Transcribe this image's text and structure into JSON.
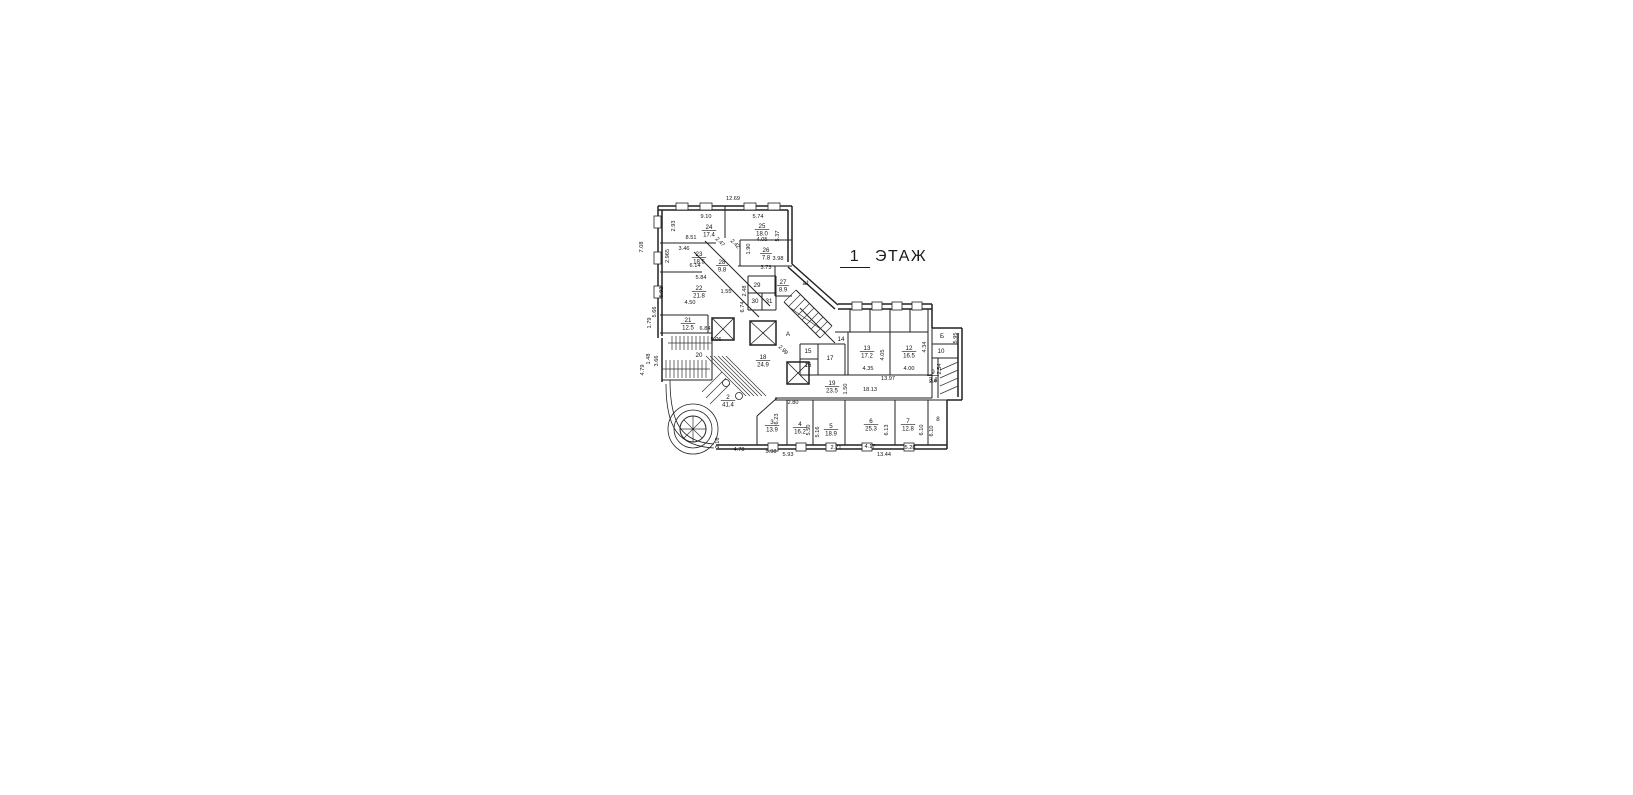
{
  "title": {
    "number": "1",
    "word": "ЭТАЖ"
  },
  "colors": {
    "ink": "#222222",
    "background": "#ffffff"
  },
  "plan": {
    "rooms": [
      {
        "num": "24",
        "area": "17.4",
        "x": 709,
        "y": 229
      },
      {
        "num": "25",
        "area": "18.0",
        "x": 762,
        "y": 228
      },
      {
        "num": "23",
        "area": "18.5",
        "x": 699,
        "y": 256
      },
      {
        "num": "26",
        "area": "7.8",
        "x": 766,
        "y": 252
      },
      {
        "num": "28",
        "area": "9.8",
        "x": 722,
        "y": 264
      },
      {
        "num": "27",
        "area": "8.9",
        "x": 783,
        "y": 284
      },
      {
        "num": "22",
        "area": "21.8",
        "x": 699,
        "y": 290
      },
      {
        "num": "21",
        "area": "12.5",
        "x": 688,
        "y": 322
      },
      {
        "num": "18",
        "area": "24.9",
        "x": 763,
        "y": 359
      },
      {
        "num": "2",
        "area": "41.4",
        "x": 728,
        "y": 399
      },
      {
        "num": "3",
        "area": "13.9",
        "x": 772,
        "y": 424
      },
      {
        "num": "4",
        "area": "16.2",
        "x": 800,
        "y": 426
      },
      {
        "num": "5",
        "area": "18.9",
        "x": 831,
        "y": 428
      },
      {
        "num": "6",
        "area": "25.3",
        "x": 871,
        "y": 423
      },
      {
        "num": "7",
        "area": "12.8",
        "x": 908,
        "y": 423
      },
      {
        "num": "13",
        "area": "17.2",
        "x": 867,
        "y": 350
      },
      {
        "num": "12",
        "area": "16.5",
        "x": 909,
        "y": 350
      },
      {
        "num": "19",
        "area": "23.5",
        "x": 832,
        "y": 385
      },
      {
        "num": "9",
        "area": "3.4",
        "x": 933,
        "y": 374
      }
    ],
    "marks": [
      {
        "t": "20",
        "x": 699,
        "y": 357
      },
      {
        "t": "29",
        "x": 757,
        "y": 287
      },
      {
        "t": "30",
        "x": 755,
        "y": 303
      },
      {
        "t": "31",
        "x": 769,
        "y": 303
      },
      {
        "t": "14",
        "x": 841,
        "y": 341
      },
      {
        "t": "17",
        "x": 830,
        "y": 360
      },
      {
        "t": "15",
        "x": 808,
        "y": 353
      },
      {
        "t": "16",
        "x": 808,
        "y": 367
      },
      {
        "t": "10",
        "x": 941,
        "y": 353
      },
      {
        "t": "8",
        "x": 938,
        "y": 421
      },
      {
        "t": "А",
        "x": 788,
        "y": 336
      },
      {
        "t": "Б",
        "x": 942,
        "y": 338
      },
      {
        "t": "а1",
        "x": 806,
        "y": 285
      }
    ],
    "dims": [
      {
        "v": "12.69",
        "x": 733,
        "y": 200,
        "rot": 0
      },
      {
        "v": "9.10",
        "x": 706,
        "y": 218,
        "rot": 0
      },
      {
        "v": "2.93",
        "x": 675,
        "y": 226,
        "rot": 90
      },
      {
        "v": "8.51",
        "x": 691,
        "y": 239,
        "rot": 0
      },
      {
        "v": "5.74",
        "x": 758,
        "y": 218,
        "rot": 0
      },
      {
        "v": "5.37",
        "x": 779,
        "y": 236,
        "rot": 90
      },
      {
        "v": "4.05",
        "x": 762,
        "y": 241,
        "rot": 0
      },
      {
        "v": "3.46",
        "x": 684,
        "y": 250,
        "rot": 0
      },
      {
        "v": "2.965",
        "x": 669,
        "y": 256,
        "rot": 90
      },
      {
        "v": "2.47",
        "x": 719,
        "y": 243,
        "rot": 45
      },
      {
        "v": "2.42",
        "x": 734,
        "y": 245,
        "rot": 45
      },
      {
        "v": "1.90",
        "x": 750,
        "y": 249,
        "rot": 90
      },
      {
        "v": "3.98",
        "x": 778,
        "y": 260,
        "rot": 0
      },
      {
        "v": "3.73",
        "x": 766,
        "y": 269,
        "rot": 0
      },
      {
        "v": "6.14",
        "x": 695,
        "y": 267,
        "rot": 0
      },
      {
        "v": "5.84",
        "x": 701,
        "y": 279,
        "rot": 0
      },
      {
        "v": "5.92",
        "x": 663,
        "y": 292,
        "rot": 90
      },
      {
        "v": "2.48",
        "x": 746,
        "y": 291,
        "rot": 90
      },
      {
        "v": "1.55",
        "x": 726,
        "y": 293,
        "rot": 0
      },
      {
        "v": "6.74",
        "x": 744,
        "y": 307,
        "rot": 90
      },
      {
        "v": "4.50",
        "x": 690,
        "y": 304,
        "rot": 0
      },
      {
        "v": "7.08",
        "x": 643,
        "y": 247,
        "rot": 90
      },
      {
        "v": "5.66",
        "x": 656,
        "y": 312,
        "rot": 90
      },
      {
        "v": "1.79",
        "x": 651,
        "y": 323,
        "rot": 90
      },
      {
        "v": "6.84",
        "x": 705,
        "y": 330,
        "rot": 0
      },
      {
        "v": "5.06",
        "x": 716,
        "y": 341,
        "rot": 0
      },
      {
        "v": "1.48",
        "x": 650,
        "y": 359,
        "rot": 90
      },
      {
        "v": "3.66",
        "x": 658,
        "y": 361,
        "rot": 90
      },
      {
        "v": "4.79",
        "x": 644,
        "y": 370,
        "rot": 90
      },
      {
        "v": "2.99",
        "x": 782,
        "y": 351,
        "rot": 45
      },
      {
        "v": "4.35",
        "x": 868,
        "y": 370,
        "rot": 0
      },
      {
        "v": "4.05",
        "x": 884,
        "y": 355,
        "rot": 90
      },
      {
        "v": "4.00",
        "x": 909,
        "y": 370,
        "rot": 0
      },
      {
        "v": "4.34",
        "x": 926,
        "y": 347,
        "rot": 90
      },
      {
        "v": "13.97",
        "x": 888,
        "y": 380,
        "rot": 0
      },
      {
        "v": "18.13",
        "x": 870,
        "y": 391,
        "rot": 0
      },
      {
        "v": "1.50",
        "x": 847,
        "y": 389,
        "rot": 90
      },
      {
        "v": "2.80",
        "x": 793,
        "y": 404,
        "rot": 0
      },
      {
        "v": "2.16",
        "x": 719,
        "y": 443,
        "rot": 90
      },
      {
        "v": "6.23",
        "x": 778,
        "y": 419,
        "rot": 90
      },
      {
        "v": "5.98",
        "x": 771,
        "y": 453,
        "rot": 0
      },
      {
        "v": "2.71",
        "x": 836,
        "y": 449,
        "rot": 0
      },
      {
        "v": "5.50",
        "x": 810,
        "y": 430,
        "rot": 90
      },
      {
        "v": "5.16",
        "x": 819,
        "y": 432,
        "rot": 90
      },
      {
        "v": "4.17",
        "x": 870,
        "y": 448,
        "rot": 0
      },
      {
        "v": "6.13",
        "x": 888,
        "y": 430,
        "rot": 90
      },
      {
        "v": "5.28",
        "x": 910,
        "y": 449,
        "rot": 0
      },
      {
        "v": "6.10",
        "x": 923,
        "y": 430,
        "rot": 90
      },
      {
        "v": "6.10",
        "x": 933,
        "y": 431,
        "rot": 90
      },
      {
        "v": "2.54",
        "x": 941,
        "y": 369,
        "rot": 90
      },
      {
        "v": "2.4",
        "x": 933,
        "y": 383,
        "rot": 0
      },
      {
        "v": "5.95",
        "x": 957,
        "y": 338,
        "rot": 90
      },
      {
        "v": "4.78",
        "x": 739,
        "y": 451,
        "rot": 0
      },
      {
        "v": "5.93",
        "x": 788,
        "y": 456,
        "rot": 0
      },
      {
        "v": "13.44",
        "x": 884,
        "y": 456,
        "rot": 0
      }
    ]
  }
}
